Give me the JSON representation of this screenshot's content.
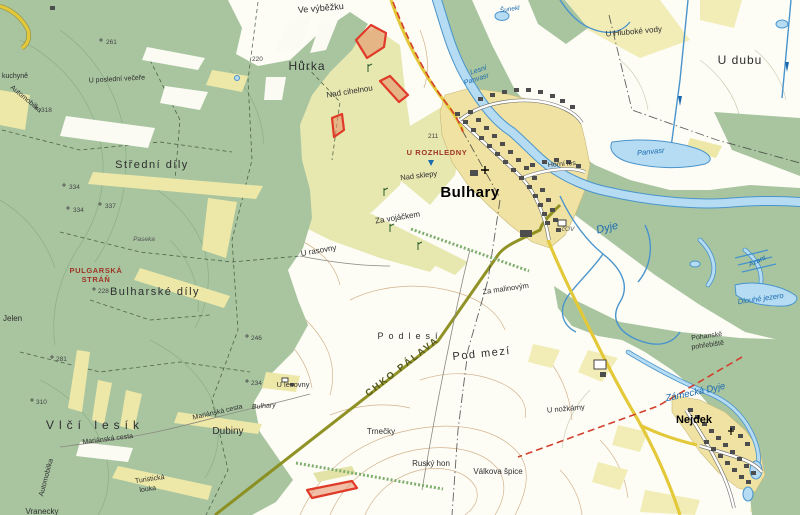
{
  "labels": {
    "kuchyne": "kuchyně",
    "automobilka": "Automobilka",
    "posledni_vecere": "U poslední večeře",
    "stredni_dily": "Střední díly",
    "pulgarska_1": "PULGARSKÁ",
    "pulgarska_2": "STRÁŇ",
    "bulharske_dily": "Bulharské díly",
    "jelen": "Jelen",
    "paseka": "Paseka",
    "vlci_lesik": "Vlčí lesík",
    "marianska_cesta": "Mariánská cesta",
    "dubiny": "Dubiny",
    "turisticka_1": "Turistická",
    "turisticka_2": "louka",
    "vranecky": "Vranecky",
    "ve_vybezku": "Ve výběžku",
    "hurka": "Hůrka",
    "nad_cihelnou": "Nad cihelnou",
    "nad_sklepy": "Nad sklepy",
    "u_rozhledny": "U ROZHLEDNY",
    "za_vojackem": "Za vojáčkem",
    "u_rasovny": "U rasovny",
    "za_malinovym": "Za malinovým",
    "podlesi": "Podlesí",
    "pod_mezi": "Pod mezí",
    "chko_palava": "CHKO PÁLAVA",
    "trnecky": "Trnečky",
    "rusky_hon": "Ruský hon",
    "valkova_spice": "Válkova špice",
    "u_lesovny": "U lesovny",
    "u_nozkarny": "U nožkárny",
    "bulhary_town": "Bulhary",
    "bulhary_sign": "Bulhary",
    "nejdek_town": "Nejdek",
    "u_hluboke_vody": "U Hluboké vody",
    "u_dubu": "U dubu",
    "horni_les": "Horní les",
    "pohanske_1": "Pohanské",
    "pohanske_2": "pohřebiště",
    "cov": "čOV",
    "dyje": "Dyje",
    "zamecka_dyje": "Zámecká Dyje",
    "panvasr": "Panvasr",
    "lesni_1": "Lesní",
    "lesni_2": "Panvasr",
    "sunekl": "Šunekl",
    "dlouhe_jezero": "Dlouhé jezero",
    "azant": "Azant"
  },
  "spot_heights": [
    "261",
    "318",
    "334",
    "334",
    "337",
    "228",
    "246",
    "281",
    "310",
    "234",
    "211",
    "220"
  ],
  "colors": {
    "forest": "#a8c5a0",
    "field_green": "#e7e7b0",
    "field_yellow": "#f2edb6",
    "village": "#efe2a2",
    "water_fill": "#b5dcf2",
    "water_line": "#4a94cc",
    "road_yellow": "#e3c839",
    "protected_area_line": "#8a8c1a",
    "trail_red": "#d2402e",
    "highlight_stroke": "#e03a28",
    "highlight_fill": "#e58c64",
    "contour": "#c49a6a"
  }
}
